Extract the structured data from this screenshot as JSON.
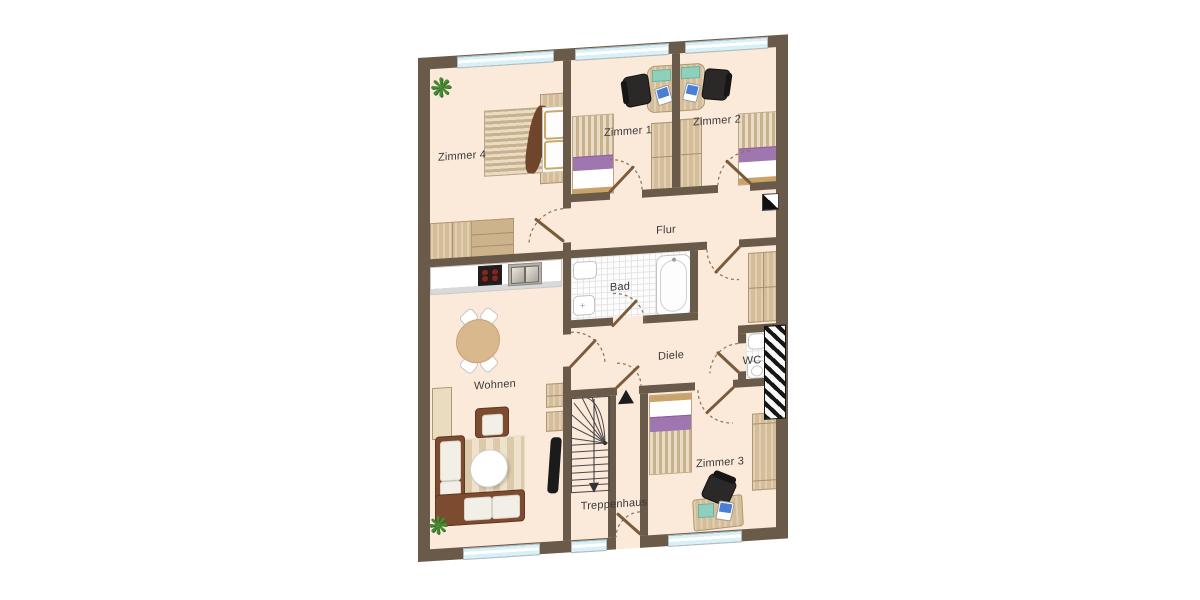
{
  "floorplan": {
    "rooms": [
      {
        "id": "zimmer4",
        "label": "Zimmer 4"
      },
      {
        "id": "zimmer1",
        "label": "Zimmer 1"
      },
      {
        "id": "zimmer2",
        "label": "Zimmer 2"
      },
      {
        "id": "flur",
        "label": "Flur"
      },
      {
        "id": "bad",
        "label": "Bad"
      },
      {
        "id": "diele",
        "label": "Diele"
      },
      {
        "id": "wc",
        "label": "WC"
      },
      {
        "id": "wohnen",
        "label": "Wohnen"
      },
      {
        "id": "treppenhaus",
        "label": "Treppenhaus"
      },
      {
        "id": "zimmer3",
        "label": "Zimmer 3"
      }
    ],
    "icons": {
      "plant_glyph": "❋"
    },
    "colors": {
      "wall": "#6a5a49",
      "floor": "#fbe9da",
      "window_glass": "#d8f1f8",
      "wood": "#d5bd98",
      "bed_accent_purple": "#9f76b0",
      "sofa_brown": "#7c4b30",
      "door_arc": "#8b7355",
      "office_chair": "#2b2828",
      "laptop_screen": "#4a7fd4",
      "desk_mat": "#8fd0bd"
    }
  }
}
